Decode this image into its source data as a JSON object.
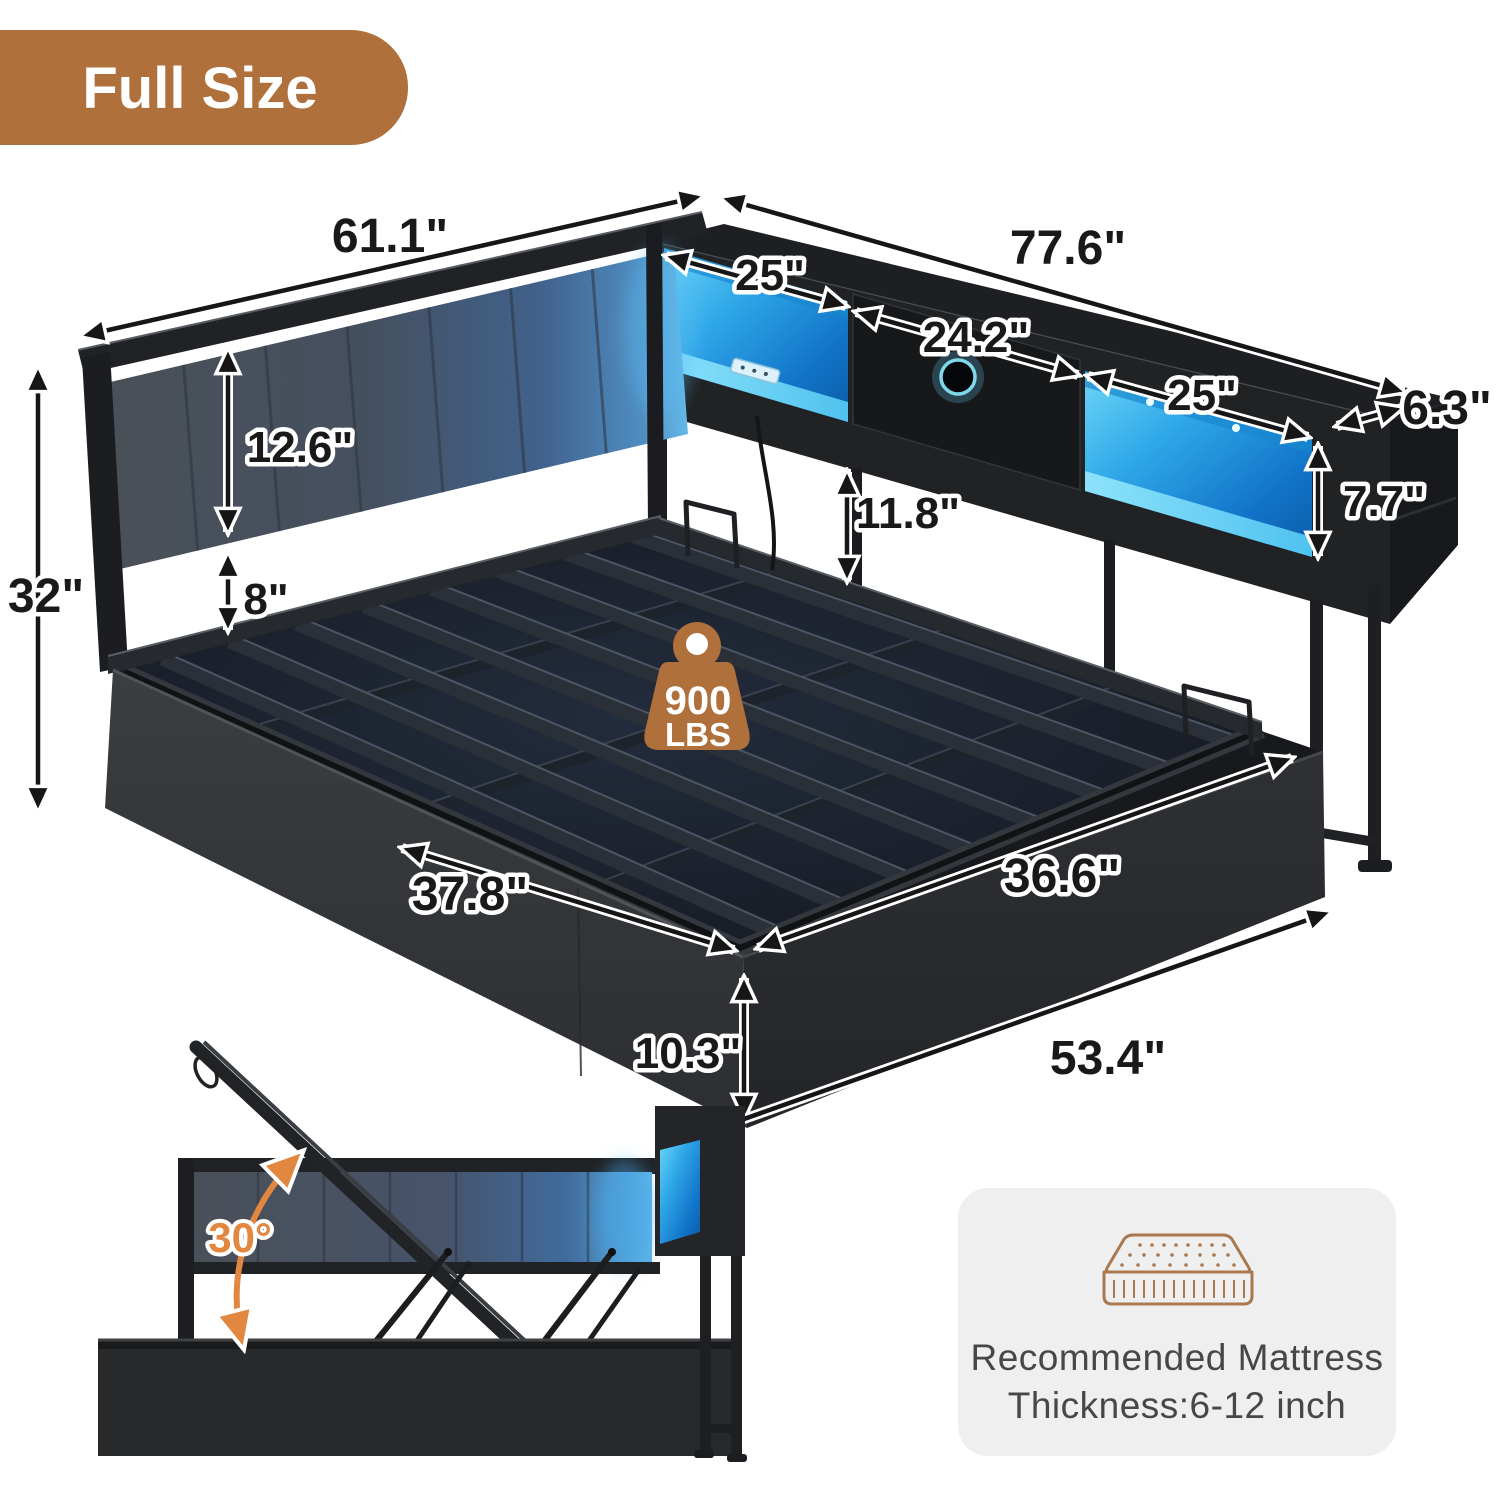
{
  "badge": {
    "label": "Full Size"
  },
  "diagram": {
    "dimensions": {
      "headboard_width": "61.1\"",
      "bookcase_length": "77.6\"",
      "left_shelf_width": "25\"",
      "drawer_width": "24.2\"",
      "right_shelf_width": "25\"",
      "bookcase_depth": "6.3\"",
      "shelf_opening_height": "7.7\"",
      "cushion_height": "12.6\"",
      "cushion_to_platform": "8\"",
      "headboard_total_height": "32\"",
      "under_shelf_clearance": "11.8\"",
      "platform_width": "37.8\"",
      "platform_length": "36.6\"",
      "storage_base_height": "10.3\"",
      "base_front_length": "53.4\""
    },
    "weight_capacity": {
      "value": "900",
      "unit": "LBS"
    },
    "lift_inset": {
      "open_angle": "30°"
    },
    "icons": {
      "weight": "weight-icon",
      "mattress": "mattress-icon"
    }
  },
  "mattress_card": {
    "line1": "Recommended Mattress",
    "line2": "Thickness:6-12 inch"
  },
  "colors": {
    "accent_brown": "#b0703c",
    "led_blue": "#38b9f2",
    "angle_orange": "#e2873f",
    "fabric_gray": "#4a5058",
    "frame_black": "#202225",
    "card_gray": "#efeff0"
  }
}
